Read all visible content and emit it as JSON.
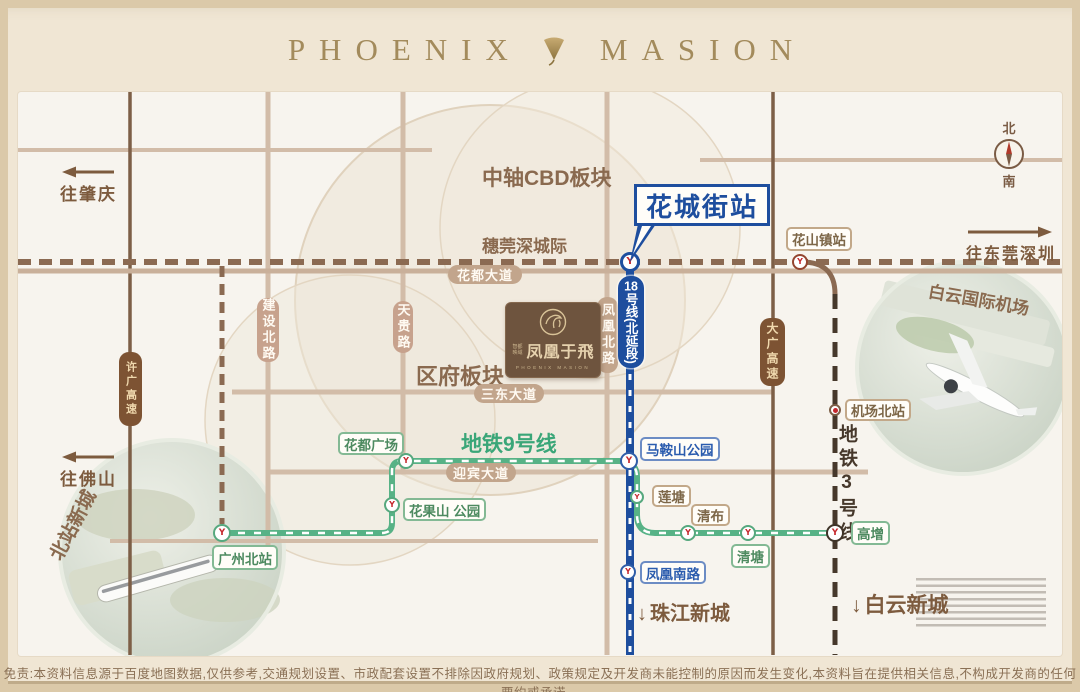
{
  "title": {
    "left": "PHOENIX",
    "right": "MASION"
  },
  "compass": {
    "north": "北",
    "south": "南"
  },
  "callout": {
    "label": "花城街站"
  },
  "line18_badge": {
    "num": "18",
    "rest": "号线(北延段)"
  },
  "logo": {
    "brand_small": "智都映域",
    "brand_cn": "凤凰于飛",
    "brand_en": "PHOENIX MASION"
  },
  "disclaimer": "免责:本资料信息源于百度地图数据,仅供参考,交通规划设置、市政配套设置不排除因政府规划、政策规定及开发商未能控制的原因而发生变化,本资料旨在提供相关信息,不构成开发商的任何要约或承诺。",
  "arrows": [
    {
      "id": "zhaoqing",
      "label": "往肇庆",
      "dir": "left",
      "x": 60,
      "y": 165,
      "len": 52
    },
    {
      "id": "foshan",
      "label": "往佛山",
      "dir": "left",
      "x": 60,
      "y": 450,
      "len": 52
    },
    {
      "id": "dongguan-shenzhen",
      "label": "往东莞深圳",
      "dir": "right",
      "x": 966,
      "y": 228,
      "len": 82
    }
  ],
  "colors": {
    "tan": "#d2bca8",
    "tan2": "#c9b09a",
    "hw": "#7d5f47",
    "rail": "#8b6a52",
    "dark": "#46382b",
    "green": "#57b286",
    "blue": "#1e4e9e",
    "brown_text": "#8a6a4f",
    "accent_blue": "#1e4e9e",
    "accent_green": "#3aa678",
    "metro_red": "#c5282d"
  },
  "map": {
    "area_labels": [
      {
        "id": "cbd-board",
        "label": "中轴CBD板块",
        "x": 482,
        "y": 162,
        "size": 21,
        "color": "#8a6a4f"
      },
      {
        "id": "suiguanshen",
        "label": "穗莞深城际",
        "x": 482,
        "y": 232,
        "size": 17,
        "color": "#8a6a4f"
      },
      {
        "id": "qufu-board",
        "label": "区府板块",
        "x": 416,
        "y": 359,
        "size": 22,
        "color": "#8a6a4f"
      },
      {
        "id": "metro-line9",
        "label": "地铁9号线",
        "x": 461,
        "y": 428,
        "size": 21,
        "color": "#3aa678"
      },
      {
        "id": "metro-line3",
        "label": "地铁3号线",
        "x": 833,
        "y": 424,
        "size": 19,
        "color": "#46382b",
        "vertical": true
      },
      {
        "id": "beizhan-newtown",
        "label": "北站新城",
        "x": 34,
        "y": 511,
        "size": 19,
        "color": "#8a6a4f",
        "rotate": -62
      },
      {
        "id": "baiyun-airport",
        "label": "白云国际机场",
        "x": 928,
        "y": 286,
        "size": 17,
        "color": "#8a6a4f",
        "rotate": 10
      },
      {
        "id": "zhujiang-newtown",
        "label": "珠江新城",
        "x": 637,
        "y": 597,
        "size": 20,
        "color": "#7d5b3e",
        "arrow": "down"
      },
      {
        "id": "baiyun-newtown",
        "label": "白云新城",
        "x": 851,
        "y": 589,
        "size": 21,
        "color": "#7d5b3e",
        "arrow": "down"
      }
    ],
    "road_pills": [
      {
        "id": "huadu-avenue",
        "label": "花都大道",
        "x": 448,
        "y": 265,
        "w": 74,
        "h": 19
      },
      {
        "id": "sandong-avenue",
        "label": "三东大道",
        "x": 474,
        "y": 384,
        "w": 70,
        "h": 19
      },
      {
        "id": "yingbin-avenue",
        "label": "迎宾大道",
        "x": 446,
        "y": 463,
        "w": 70,
        "h": 19
      },
      {
        "id": "jianshe-north-rd",
        "label": "建设北路",
        "x": 257,
        "y": 298,
        "w": 22,
        "h": 64,
        "vertical": true,
        "theme": "rose"
      },
      {
        "id": "tiangui-rd",
        "label": "天贵路",
        "x": 393,
        "y": 301,
        "w": 20,
        "h": 52,
        "vertical": true,
        "theme": "rose"
      },
      {
        "id": "fenghuang-north-rd",
        "label": "凤凰北路",
        "x": 597,
        "y": 297,
        "w": 21,
        "h": 76,
        "vertical": true
      },
      {
        "id": "xuguang-expwy",
        "label": "许广高速",
        "x": 119,
        "y": 352,
        "w": 23,
        "h": 74,
        "vertical": true,
        "theme": "dark",
        "fs": 11
      },
      {
        "id": "daguang-expwy",
        "label": "大广高速",
        "x": 760,
        "y": 318,
        "w": 25,
        "h": 68,
        "vertical": true,
        "theme": "dark",
        "fs": 12
      }
    ],
    "station_labels": [
      {
        "id": "huashanzhen",
        "label": "花山镇站",
        "x": 786,
        "y": 227,
        "h": 24,
        "theme": "tan"
      },
      {
        "id": "jichangbei",
        "label": "机场北站",
        "x": 845,
        "y": 399,
        "h": 22,
        "theme": "tan"
      },
      {
        "id": "gaozeng",
        "label": "高增",
        "x": 851,
        "y": 521,
        "h": 24,
        "theme": "green"
      },
      {
        "id": "qingtang",
        "label": "清塘",
        "x": 731,
        "y": 544,
        "h": 24,
        "theme": "green"
      },
      {
        "id": "qingbu",
        "label": "清布",
        "x": 691,
        "y": 504,
        "h": 22,
        "theme": "tan"
      },
      {
        "id": "liantang",
        "label": "莲塘",
        "x": 652,
        "y": 485,
        "h": 22,
        "theme": "tan"
      },
      {
        "id": "maanshan-park",
        "label": "马鞍山公园",
        "x": 640,
        "y": 437,
        "h": 24,
        "theme": "blue"
      },
      {
        "id": "fenghuang-south-rd",
        "label": "凤凰南路",
        "x": 640,
        "y": 561,
        "h": 23,
        "theme": "blue"
      },
      {
        "id": "guangzhou-north",
        "label": "广州北站",
        "x": 212,
        "y": 545,
        "h": 25,
        "theme": "green"
      },
      {
        "id": "huadu-square",
        "label": "花都广场",
        "x": 338,
        "y": 432,
        "h": 23,
        "theme": "green"
      },
      {
        "id": "huaguoshan-park",
        "label": "花果山 公园",
        "x": 403,
        "y": 498,
        "h": 23,
        "theme": "green"
      }
    ],
    "stations": [
      {
        "id": "huachengjie-stn",
        "x": 630,
        "y": 262,
        "r": 10,
        "ring": "#1e4e9e",
        "bw": 3
      },
      {
        "id": "huashanzhen-stn",
        "x": 800,
        "y": 262,
        "r": 8,
        "ring": "#94452f"
      },
      {
        "id": "maanshan-stn",
        "x": 629,
        "y": 461,
        "r": 9,
        "ring": "#2f5da8"
      },
      {
        "id": "liantang-stn",
        "x": 637,
        "y": 497,
        "r": 7,
        "ring": "#56a87e"
      },
      {
        "id": "qingbu-stn",
        "x": 688,
        "y": 533,
        "r": 8,
        "ring": "#56a87e"
      },
      {
        "id": "qingtang-stn",
        "x": 748,
        "y": 533,
        "r": 8,
        "ring": "#56a87e"
      },
      {
        "id": "gaozeng-stn",
        "x": 835,
        "y": 533,
        "r": 9,
        "ring": "#3f3428"
      },
      {
        "id": "fenghuangnan-stn",
        "x": 628,
        "y": 572,
        "r": 8,
        "ring": "#2f5da8"
      },
      {
        "id": "huaduguangchang-stn",
        "x": 406,
        "y": 461,
        "r": 8,
        "ring": "#56a87e"
      },
      {
        "id": "huaguoshan-stn",
        "x": 392,
        "y": 505,
        "r": 8,
        "ring": "#56a87e"
      },
      {
        "id": "guangzhoubei-stn",
        "x": 222,
        "y": 533,
        "r": 9,
        "ring": "#56a87e"
      },
      {
        "id": "jichangbei-stn",
        "x": 835,
        "y": 410,
        "r": 6,
        "ring": "#7d5f47",
        "glyph": "dot"
      }
    ],
    "lines": [
      {
        "name": "road-top-left",
        "d": "M18,150 H432",
        "stroke": "tan",
        "w": 4
      },
      {
        "name": "road-top-right",
        "d": "M700,160 H1062",
        "stroke": "tan",
        "w": 4
      },
      {
        "name": "road-sandong",
        "d": "M232,392 H772",
        "stroke": "tan",
        "w": 5
      },
      {
        "name": "road-yingbin",
        "d": "M270,472 H868",
        "stroke": "tan",
        "w": 5
      },
      {
        "name": "road-south",
        "d": "M110,541 H598",
        "stroke": "tan",
        "w": 4
      },
      {
        "name": "road-jianshe-north",
        "d": "M268,92 V545",
        "stroke": "tan",
        "w": 5
      },
      {
        "name": "road-tiangui",
        "d": "M403,92 V472",
        "stroke": "tan",
        "w": 5
      },
      {
        "name": "road-fenghuang-north",
        "d": "M607,92 V655",
        "stroke": "tan",
        "w": 5
      },
      {
        "name": "expwy-xuguang",
        "d": "M130,92 V655",
        "stroke": "hw",
        "w": 3.5
      },
      {
        "name": "expwy-daguang",
        "d": "M773,92 V655",
        "stroke": "hw",
        "w": 3.5
      },
      {
        "name": "road-huadu-avenue",
        "d": "M18,271 H1062",
        "stroke": "tan2",
        "w": 5
      },
      {
        "name": "rail-suiguanshen",
        "d": "M18,262 H1062",
        "stroke": "rail",
        "w": 6,
        "dash": "13 8"
      },
      {
        "name": "rail-branch-gzbei",
        "d": "M222,266 V524",
        "stroke": "rail",
        "w": 5,
        "dash": "11 7"
      },
      {
        "name": "line3-connector",
        "d": "M802,262 Q835,262 835,294",
        "stroke": "rail",
        "w": 5
      },
      {
        "name": "metro-line3-track",
        "d": "M835,294 V655",
        "stroke": "dark",
        "w": 5,
        "dash": "15 9"
      },
      {
        "name": "metro-line9-track",
        "d": "M222,533 H382 Q392,533 392,523 V471 Q392,461 402,461 H619 Q637,461 637,477 V515 Q637,533 655,533 H835",
        "stroke": "green",
        "w": 6,
        "overlay": true,
        "ow": 2.5,
        "odash": "7 9"
      },
      {
        "name": "metro-line18-track",
        "d": "M630,262 V655",
        "stroke": "blue",
        "w": 8,
        "overlay": true,
        "ow": 3,
        "odash": "6 10"
      }
    ]
  }
}
